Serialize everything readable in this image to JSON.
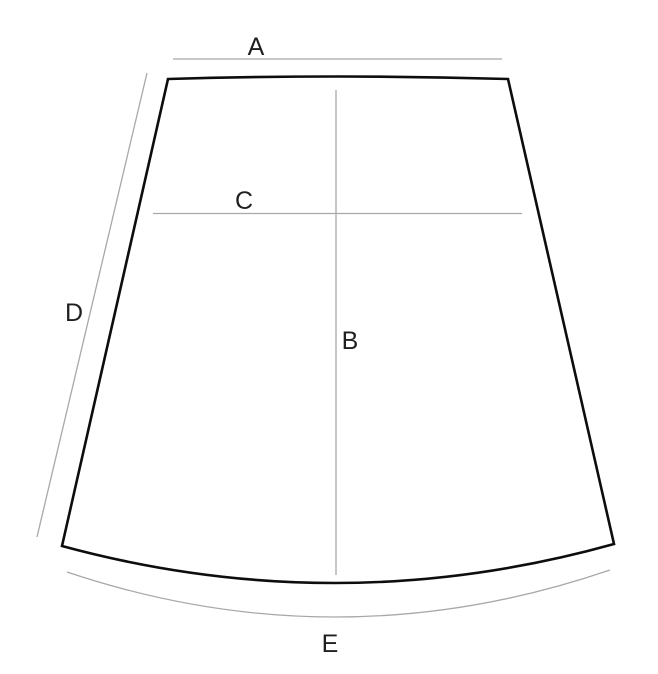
{
  "diagram": {
    "labels": {
      "a": "A",
      "b": "B",
      "c": "C",
      "d": "D",
      "e": "E"
    },
    "colors": {
      "outline": "#0d0d0d",
      "guide": "#a8a8a8",
      "label": "#1f1f1f",
      "background": "#ffffff"
    }
  }
}
